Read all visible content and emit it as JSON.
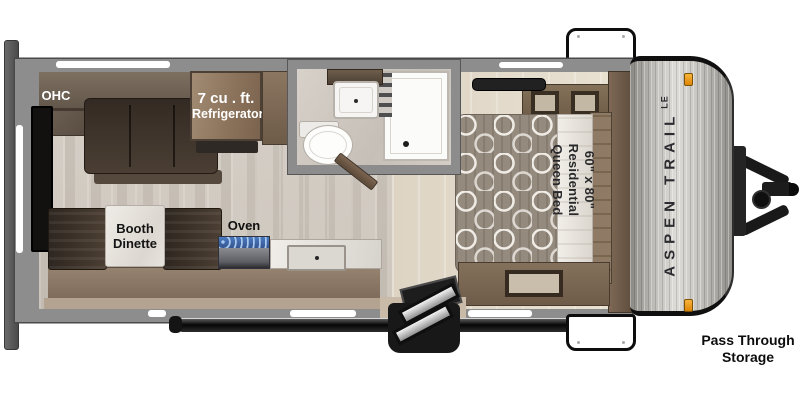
{
  "plan": {
    "title": "Aspen Trail LE travel trailer floor plan",
    "labels": {
      "ohc": "OHC",
      "refrigerator_line1": "7 cu . ft.",
      "refrigerator_line2": "Refrigerator",
      "booth_line1": "Booth",
      "booth_line2": "Dinette",
      "oven": "Oven",
      "bed_line1": "60\" x 80\"",
      "bed_line2": "Residential",
      "bed_line3": "Queen Bed",
      "pass_through_line1": "Pass Through",
      "pass_through_line2": "Storage"
    },
    "brand": {
      "name": "ASPEN TRAIL",
      "badge": "LE"
    },
    "fixtures": [
      "sofa",
      "overhead-cabinet",
      "refrigerator",
      "pantry",
      "tv",
      "booth-dinette",
      "range-oven",
      "kitchen-sink",
      "bathroom-sink",
      "toilet",
      "shower",
      "queen-bed",
      "wardrobe",
      "dresser",
      "entry-steps",
      "awning-rail",
      "pass-through-doors",
      "a-frame-hitch",
      "rear-bumper"
    ],
    "colors": {
      "wall_gray": "#8d8d8d",
      "floor_wood": "#d3ccc4",
      "bedroom_floor": "#e3dbcc",
      "cabinet_wood": "#8a715a",
      "upholstery_dark": "#3c332b",
      "marble_white": "#e9e6e1",
      "cap_silver": "#c6c4bf",
      "marker_light_amber": "#ef9b12",
      "burner_blue": "#4a79c0",
      "label_black": "#0d0d0d",
      "label_white": "#ffffff"
    }
  }
}
